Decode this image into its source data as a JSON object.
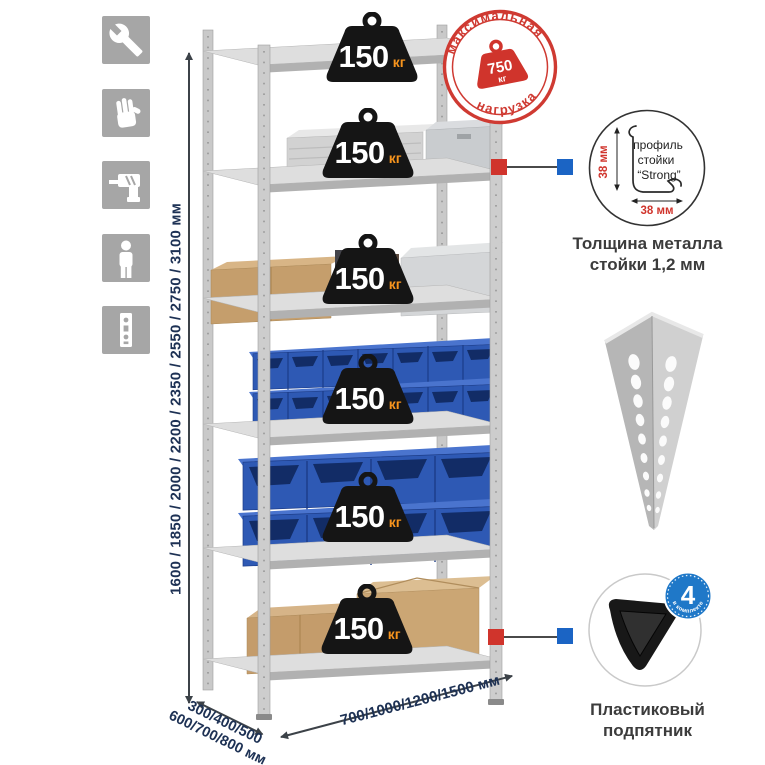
{
  "side_icons": [
    {
      "name": "wrench"
    },
    {
      "name": "gloves"
    },
    {
      "name": "drill"
    },
    {
      "name": "person"
    },
    {
      "name": "rack-post"
    }
  ],
  "dimensions": {
    "height": "1600 / 1850 / 2000 / 2200 / 2350 / 2550 / 2750 / 3100 мм",
    "depth_line1": "300/400/500",
    "depth_line2": "600/700/800 мм",
    "width": "700/1000/1200/1500 мм"
  },
  "weights": [
    {
      "value": "150",
      "unit": "кг"
    },
    {
      "value": "150",
      "unit": "кг"
    },
    {
      "value": "150",
      "unit": "кг"
    },
    {
      "value": "150",
      "unit": "кг"
    },
    {
      "value": "150",
      "unit": "кг"
    },
    {
      "value": "150",
      "unit": "кг"
    }
  ],
  "stamp": {
    "arc_top": "максимальная",
    "arc_bottom": "нагрузка",
    "value": "750",
    "unit": "кг"
  },
  "profile_callout": {
    "title_line1": "профиль",
    "title_line2": "стойки",
    "title_line3": "“Strong”",
    "dim_vertical": "38 мм",
    "dim_horizontal": "38 мм",
    "caption_line1": "Толщина металла",
    "caption_line2": "стойки 1,2 мм"
  },
  "foot_callout": {
    "badge_value": "4",
    "badge_arc": "в комплекте",
    "caption_line1": "Пластиковый",
    "caption_line2": "подпятник"
  },
  "colors": {
    "accent_red": "#d0342c",
    "accent_blue": "#1b64c4",
    "navy_text": "#1d3154",
    "weight_unit_orange": "#f7941d",
    "icon_gray": "#a6a6a6",
    "bin_blue": "#2e59b4"
  }
}
